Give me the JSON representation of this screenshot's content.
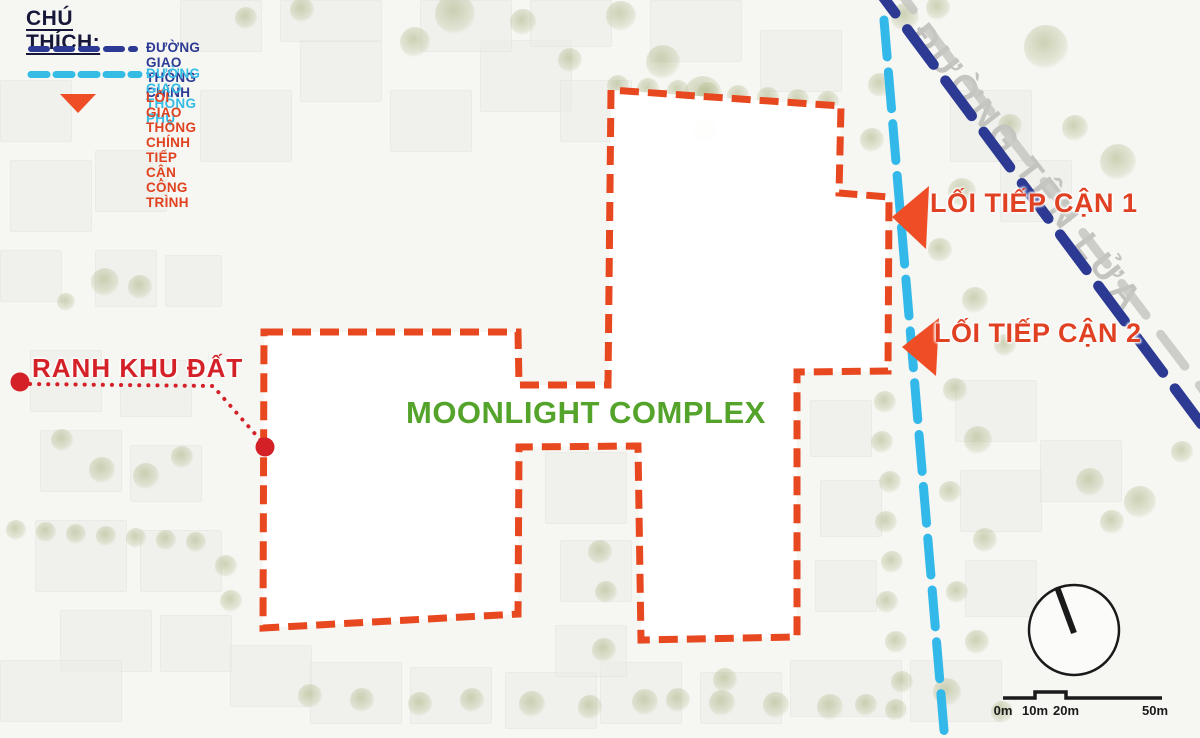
{
  "legend": {
    "title": "CHÚ THÍCH:",
    "items": [
      {
        "label": "ĐƯỜNG GIAO THÔNG CHÍNH",
        "color": "#2c3a94",
        "type": "dash"
      },
      {
        "label": "ĐƯỜNG GIAO THÔNG PHỤ",
        "color": "#35bce5",
        "type": "dash"
      },
      {
        "label": "LỐI GIAO THÔNG CHÍNH TIẾP CẬN CÔNG TRÌNH",
        "color": "#e0421f",
        "type": "arrow"
      }
    ]
  },
  "labels": {
    "site_name": "MOONLIGHT COMPLEX",
    "boundary": "RANH KHU ĐẤT",
    "access1": "LỐI TIẾP CẬN 1",
    "access2": "LỐI TIẾP CẬN 2",
    "road_name": "ĐƯỜNG TÊN LỬA"
  },
  "scale_bar": {
    "ticks": [
      "0m",
      "10m",
      "20m",
      "50m"
    ]
  },
  "colors": {
    "site_boundary": "#e8481f",
    "boundary_red": "#d42127",
    "access_text": "#e04123",
    "access_arrow": "#ee4d26",
    "main_road": "#2c3a94",
    "secondary_road": "#33b9e9",
    "road_casing": "#c6c6c2",
    "site_name_green": "#54a32a",
    "legend_title": "#17173a",
    "ink": "#1a1a1a"
  },
  "geometry": {
    "site_boundary_points": [
      [
        264,
        332
      ],
      [
        518,
        332
      ],
      [
        519,
        385
      ],
      [
        608,
        385
      ],
      [
        611,
        90
      ],
      [
        841,
        106
      ],
      [
        839,
        193
      ],
      [
        889,
        197
      ],
      [
        888,
        371
      ],
      [
        797,
        372
      ],
      [
        797,
        637
      ],
      [
        641,
        640
      ],
      [
        638,
        446
      ],
      [
        519,
        447
      ],
      [
        518,
        614
      ],
      [
        263,
        628
      ]
    ],
    "main_road": {
      "x1": 869,
      "y1": -22,
      "x2": 1208,
      "y2": 433,
      "width": 10.5,
      "dash": "44 20"
    },
    "road_casing": {
      "x1": 889,
      "y1": -22,
      "x2": 1232,
      "y2": 428,
      "width": 9,
      "dash": "40 24"
    },
    "secondary_road": {
      "x1": 884,
      "y1": 20,
      "x2": 945,
      "y2": 742,
      "width": 9,
      "dash": "37 15"
    },
    "leader_points": [
      [
        30,
        384
      ],
      [
        213,
        386
      ],
      [
        263,
        443
      ]
    ],
    "leader_dots": [
      [
        20,
        382
      ],
      [
        265,
        447
      ]
    ],
    "access_arrow_1": [
      [
        892,
        217
      ],
      [
        929,
        186
      ],
      [
        926,
        249
      ]
    ],
    "access_arrow_2": [
      [
        902,
        347
      ],
      [
        939,
        318
      ],
      [
        936,
        376
      ]
    ],
    "compass": {
      "cx": 1074,
      "cy": 630,
      "r": 45,
      "nx": 1057,
      "ny": 587
    },
    "scale_bar_path": "M1003,698 L1035,698 L1035,692 L1066,692 L1066,698 L1162,698",
    "scale_tick_x": [
      1003,
      1035,
      1066,
      1155
    ]
  }
}
